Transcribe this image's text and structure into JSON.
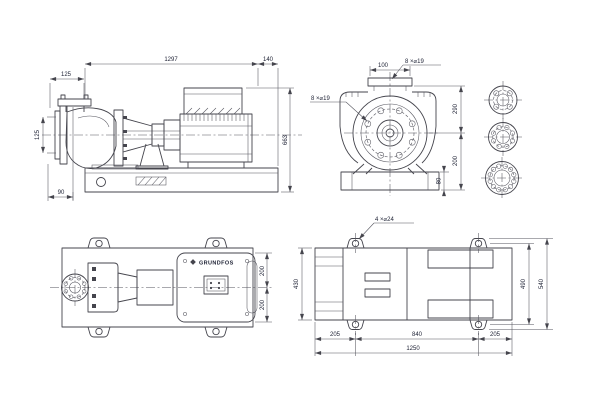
{
  "page": {
    "background": "#ffffff",
    "line_color": "#45454d",
    "dim_line_color": "#55555e",
    "text_color": "#1c2033"
  },
  "side_view": {
    "dims": {
      "overall_length": "1297",
      "rear_overhang": "140",
      "discharge_offset": "125",
      "suction_diameter": "125",
      "foot_offset": "90",
      "overall_height": "663"
    }
  },
  "front_view": {
    "dims": {
      "top_width": "100",
      "flange_to_centerline": "290",
      "centerline_to_base": "200",
      "base_height": "80"
    },
    "callouts": {
      "discharge_holes": "8 ×⌀19",
      "suction_holes": "8 ×⌀19"
    }
  },
  "pump_plan": {
    "logo": "GRUNDFOS",
    "dims": {
      "centerline_to_edge_top": "200",
      "centerline_to_edge_bottom": "200"
    }
  },
  "baseplate_plan": {
    "callouts": {
      "anchor_holes": "4 ×⌀24"
    },
    "dims": {
      "end_margin_left": "205",
      "hole_span": "840",
      "end_margin_right": "205",
      "total_length": "1250",
      "plate_width": "430",
      "hole_span_width": "490",
      "total_width": "540"
    }
  }
}
